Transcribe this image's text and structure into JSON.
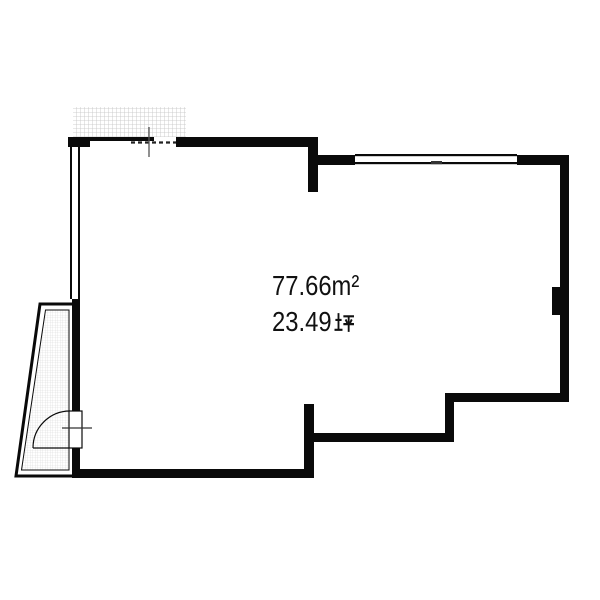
{
  "floorplan": {
    "labels": {
      "area_m2": "77.66m²",
      "area_m2_unicode": "77.66㎡",
      "area_tsubo_value": "23.49",
      "area_tsubo_unit": "坪"
    },
    "colors": {
      "wall": "#0a0a0a",
      "balcony_hatch": "#c2c2c2",
      "porch_hatch": "#d9d9d9",
      "opening_dash": "#222222",
      "tick": "#555555",
      "text": "#111111",
      "background": "#ffffff"
    },
    "features": [
      "balcony-hatched-area",
      "sliding-door-top-left",
      "window-left-wall",
      "window-top-right",
      "entrance-porch",
      "entrance-door-swing",
      "pillar-right-wall"
    ]
  }
}
